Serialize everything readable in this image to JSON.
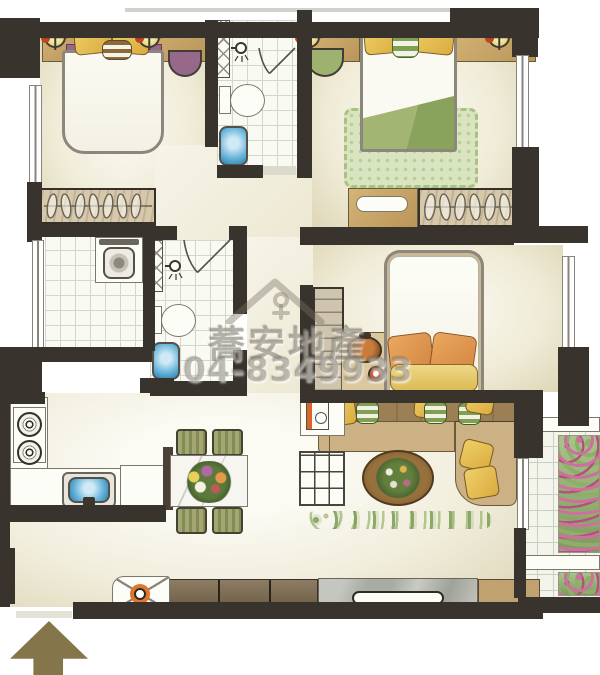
{
  "watermark": {
    "company_name": "蕎安地產",
    "phone": "04-8349933",
    "logo": "house-outline-icon"
  },
  "entrance": {
    "symbol": "up-arrow",
    "direction": "up"
  },
  "palette": {
    "wall": "#38332d",
    "floor_cream": "#efebd6",
    "wood": "#c9a96b",
    "pillow_yellow": "#e7c050",
    "accent_purple": "#96688a",
    "accent_green": "#8fa862",
    "fixture_blue": "#57a9d4",
    "balcony_flower_pink": "#cf6f9f",
    "arrow_olive": "#85754a",
    "watermark_gray": "rgba(122,115,102,0.5)"
  }
}
